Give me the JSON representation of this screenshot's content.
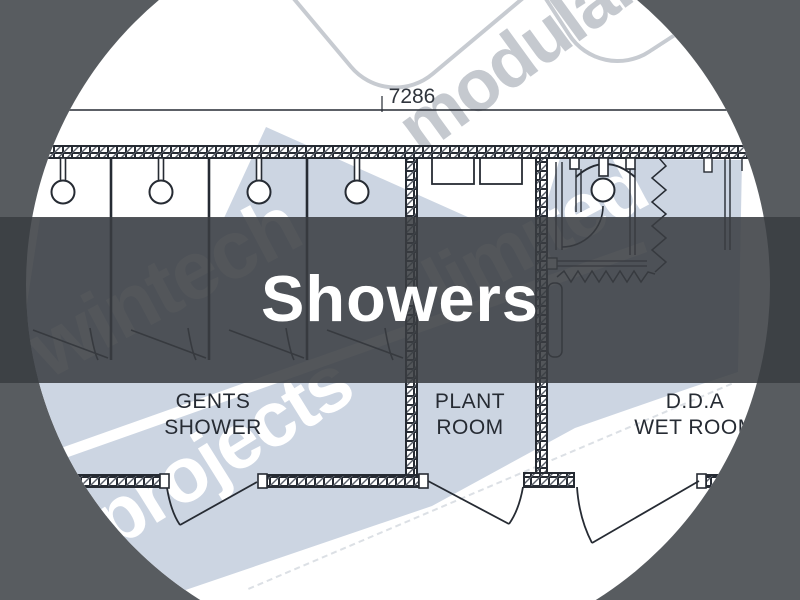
{
  "title": {
    "text": "Showers"
  },
  "plan": {
    "dimension": "7286",
    "rooms": [
      {
        "line1": "GENTS",
        "line2": "SHOWER"
      },
      {
        "line1": "PLANT",
        "line2": "ROOM"
      },
      {
        "line1": "D.D.A",
        "line2": "WET ROOM"
      }
    ]
  },
  "watermark": {
    "word_top": "wintech",
    "word_mid": "projects",
    "word_right": "limited",
    "word_upper": "modular"
  },
  "colors": {
    "page_background": "#585c60",
    "band_overlay": "#393d41",
    "plan_line": "#262b33",
    "swoosh_blue": "#ccd5e2",
    "watermark_gray": "#c5c9cf",
    "title_text": "#ffffff",
    "label_text": "#262b33"
  }
}
